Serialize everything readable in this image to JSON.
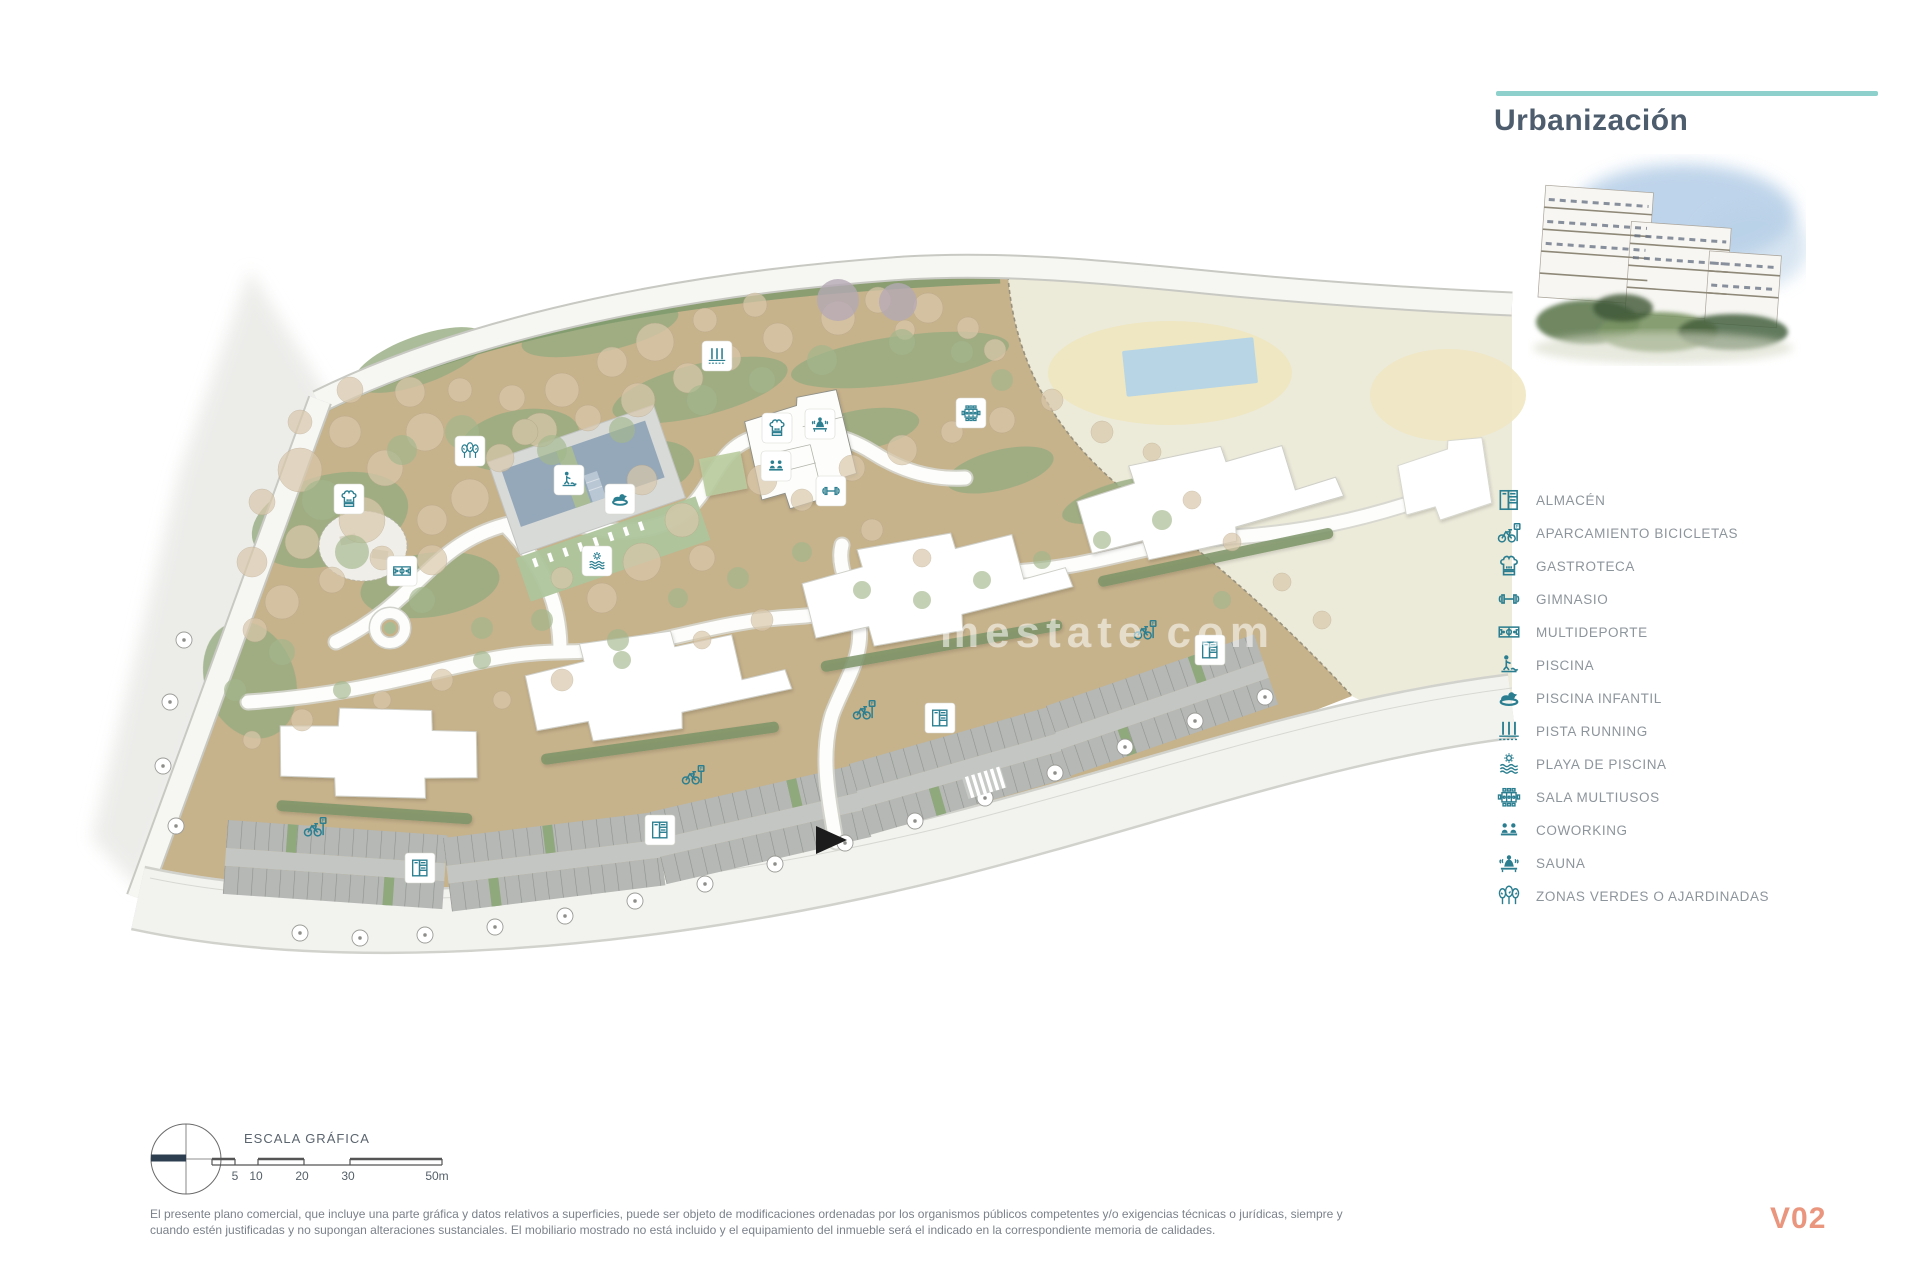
{
  "header": {
    "title": "Urbanización",
    "accent_color": "#8ed0cb",
    "title_color": "#4e5d6d"
  },
  "legend": {
    "icon_color": "#2a7e90",
    "text_color": "#8d959c",
    "items": [
      {
        "icon": "almacen-icon",
        "label": "ALMACÉN"
      },
      {
        "icon": "bike-parking-icon",
        "label": "APARCAMIENTO BICICLETAS"
      },
      {
        "icon": "gastroteca-icon",
        "label": "GASTROTECA"
      },
      {
        "icon": "gimnasio-icon",
        "label": "GIMNASIO"
      },
      {
        "icon": "multideporte-icon",
        "label": "MULTIDEPORTE"
      },
      {
        "icon": "piscina-icon",
        "label": "PISCINA"
      },
      {
        "icon": "piscina-infantil-icon",
        "label": "PISCINA INFANTIL"
      },
      {
        "icon": "pista-running-icon",
        "label": "PISTA RUNNING"
      },
      {
        "icon": "playa-piscina-icon",
        "label": "PLAYA DE PISCINA"
      },
      {
        "icon": "sala-multiusos-icon",
        "label": "SALA MULTIUSOS"
      },
      {
        "icon": "coworking-icon",
        "label": "COWORKING"
      },
      {
        "icon": "sauna-icon",
        "label": "SAUNA"
      },
      {
        "icon": "zonas-verdes-icon",
        "label": "ZONAS VERDES O AJARDINADAS"
      }
    ]
  },
  "scale": {
    "title": "ESCALA GRÁFICA",
    "ticks": [
      "5",
      "10",
      "20",
      "30",
      "50m"
    ]
  },
  "footer": {
    "disclaimer_line1": "El presente plano comercial, que incluye una parte gráfica y datos relativos a superficies, puede ser objeto de modificaciones ordenadas por los organismos públicos competentes y/o exigencias técnicas o jurídicas, siempre y",
    "disclaimer_line2": "cuando estén justificadas y no supongan alteraciones sustanciales. El mobiliario mostrado no está incluido y el equipamiento del inmueble será el indicado en la correspondiente memoria de calidades.",
    "version": "V02",
    "version_color": "#ea957d"
  },
  "watermark": {
    "text": "mestate com"
  },
  "plan_colors": {
    "ground_tan": "#c6b28b",
    "cream_zone": "#ecead9",
    "green": "#97ac81",
    "hedge": "#7d9468",
    "pool_water": "#95a8b9",
    "parking": "#b5b8b4",
    "road": "#f8f8f5",
    "icon_teal": "#2b7f91"
  }
}
